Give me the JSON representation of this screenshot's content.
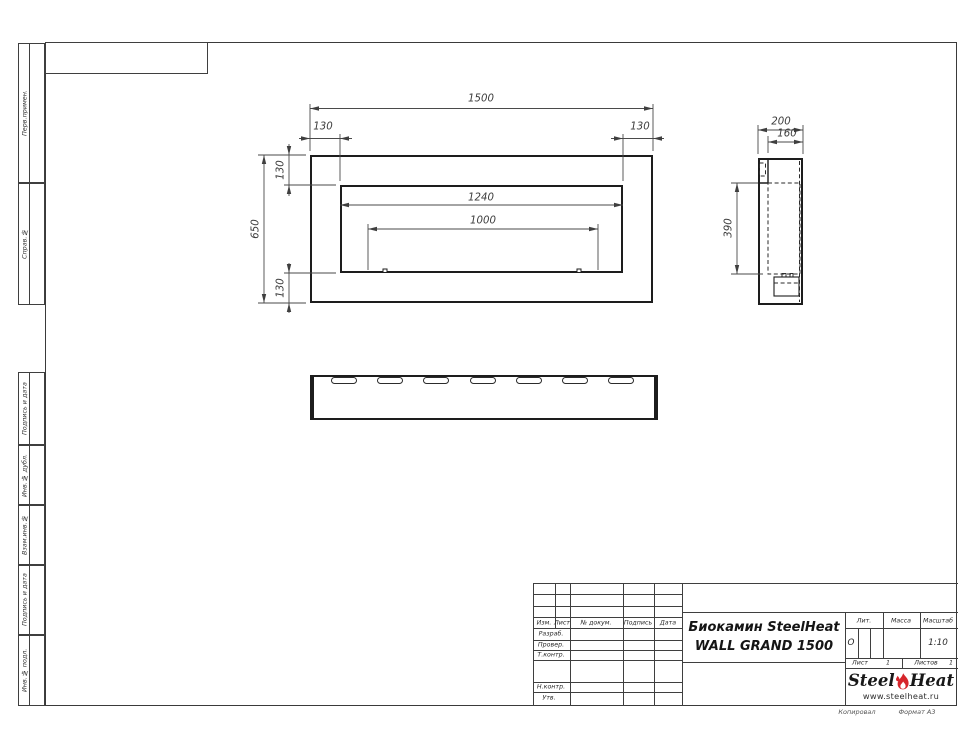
{
  "frame_labels": {
    "copied": "Копировал",
    "format": "Формат А3"
  },
  "margin_stamps": [
    "Перв.примен.",
    "Справ.№",
    "Подпись и дата",
    "Инв.№ дубл.",
    "Взам.инв.№",
    "Подпись и дата",
    "Инв.№ подл."
  ],
  "title_block": {
    "change_header": {
      "izm": "Изм.",
      "list": "Лист",
      "doc": "№ докум.",
      "sign": "Подпись",
      "date": "Дата"
    },
    "staff_rows": {
      "razrab": "Разраб.",
      "prover": "Провер.",
      "tkontr": "Т.контр.",
      "nkontr": "Н.контр.",
      "utv": "Утв."
    },
    "title_line1": "Биокамин SteelHeat",
    "title_line2": "WALL GRAND 1500",
    "lit": {
      "label": "Лит.",
      "value": "О"
    },
    "massa": {
      "label": "Масса",
      "value": ""
    },
    "scale": {
      "label": "Масштаб",
      "value": "1:10"
    },
    "sheet_no": {
      "label": "Лист",
      "value": "1"
    },
    "sheets_total": {
      "label": "Листов",
      "value": "1"
    },
    "logo": {
      "word1": "Steel",
      "word2": "Heat",
      "site": "www.steelheat.ru",
      "flame_color": "#d6252b"
    }
  },
  "dimensions": {
    "front": {
      "total_width": "1500",
      "left_inset": "130",
      "right_inset": "130",
      "top_inset": "130",
      "height": "650",
      "bottom_inset": "130",
      "opening_width": "1240",
      "burner_width": "1000"
    },
    "side": {
      "depth": "200",
      "inner_depth": "160",
      "opening_height": "390"
    }
  }
}
